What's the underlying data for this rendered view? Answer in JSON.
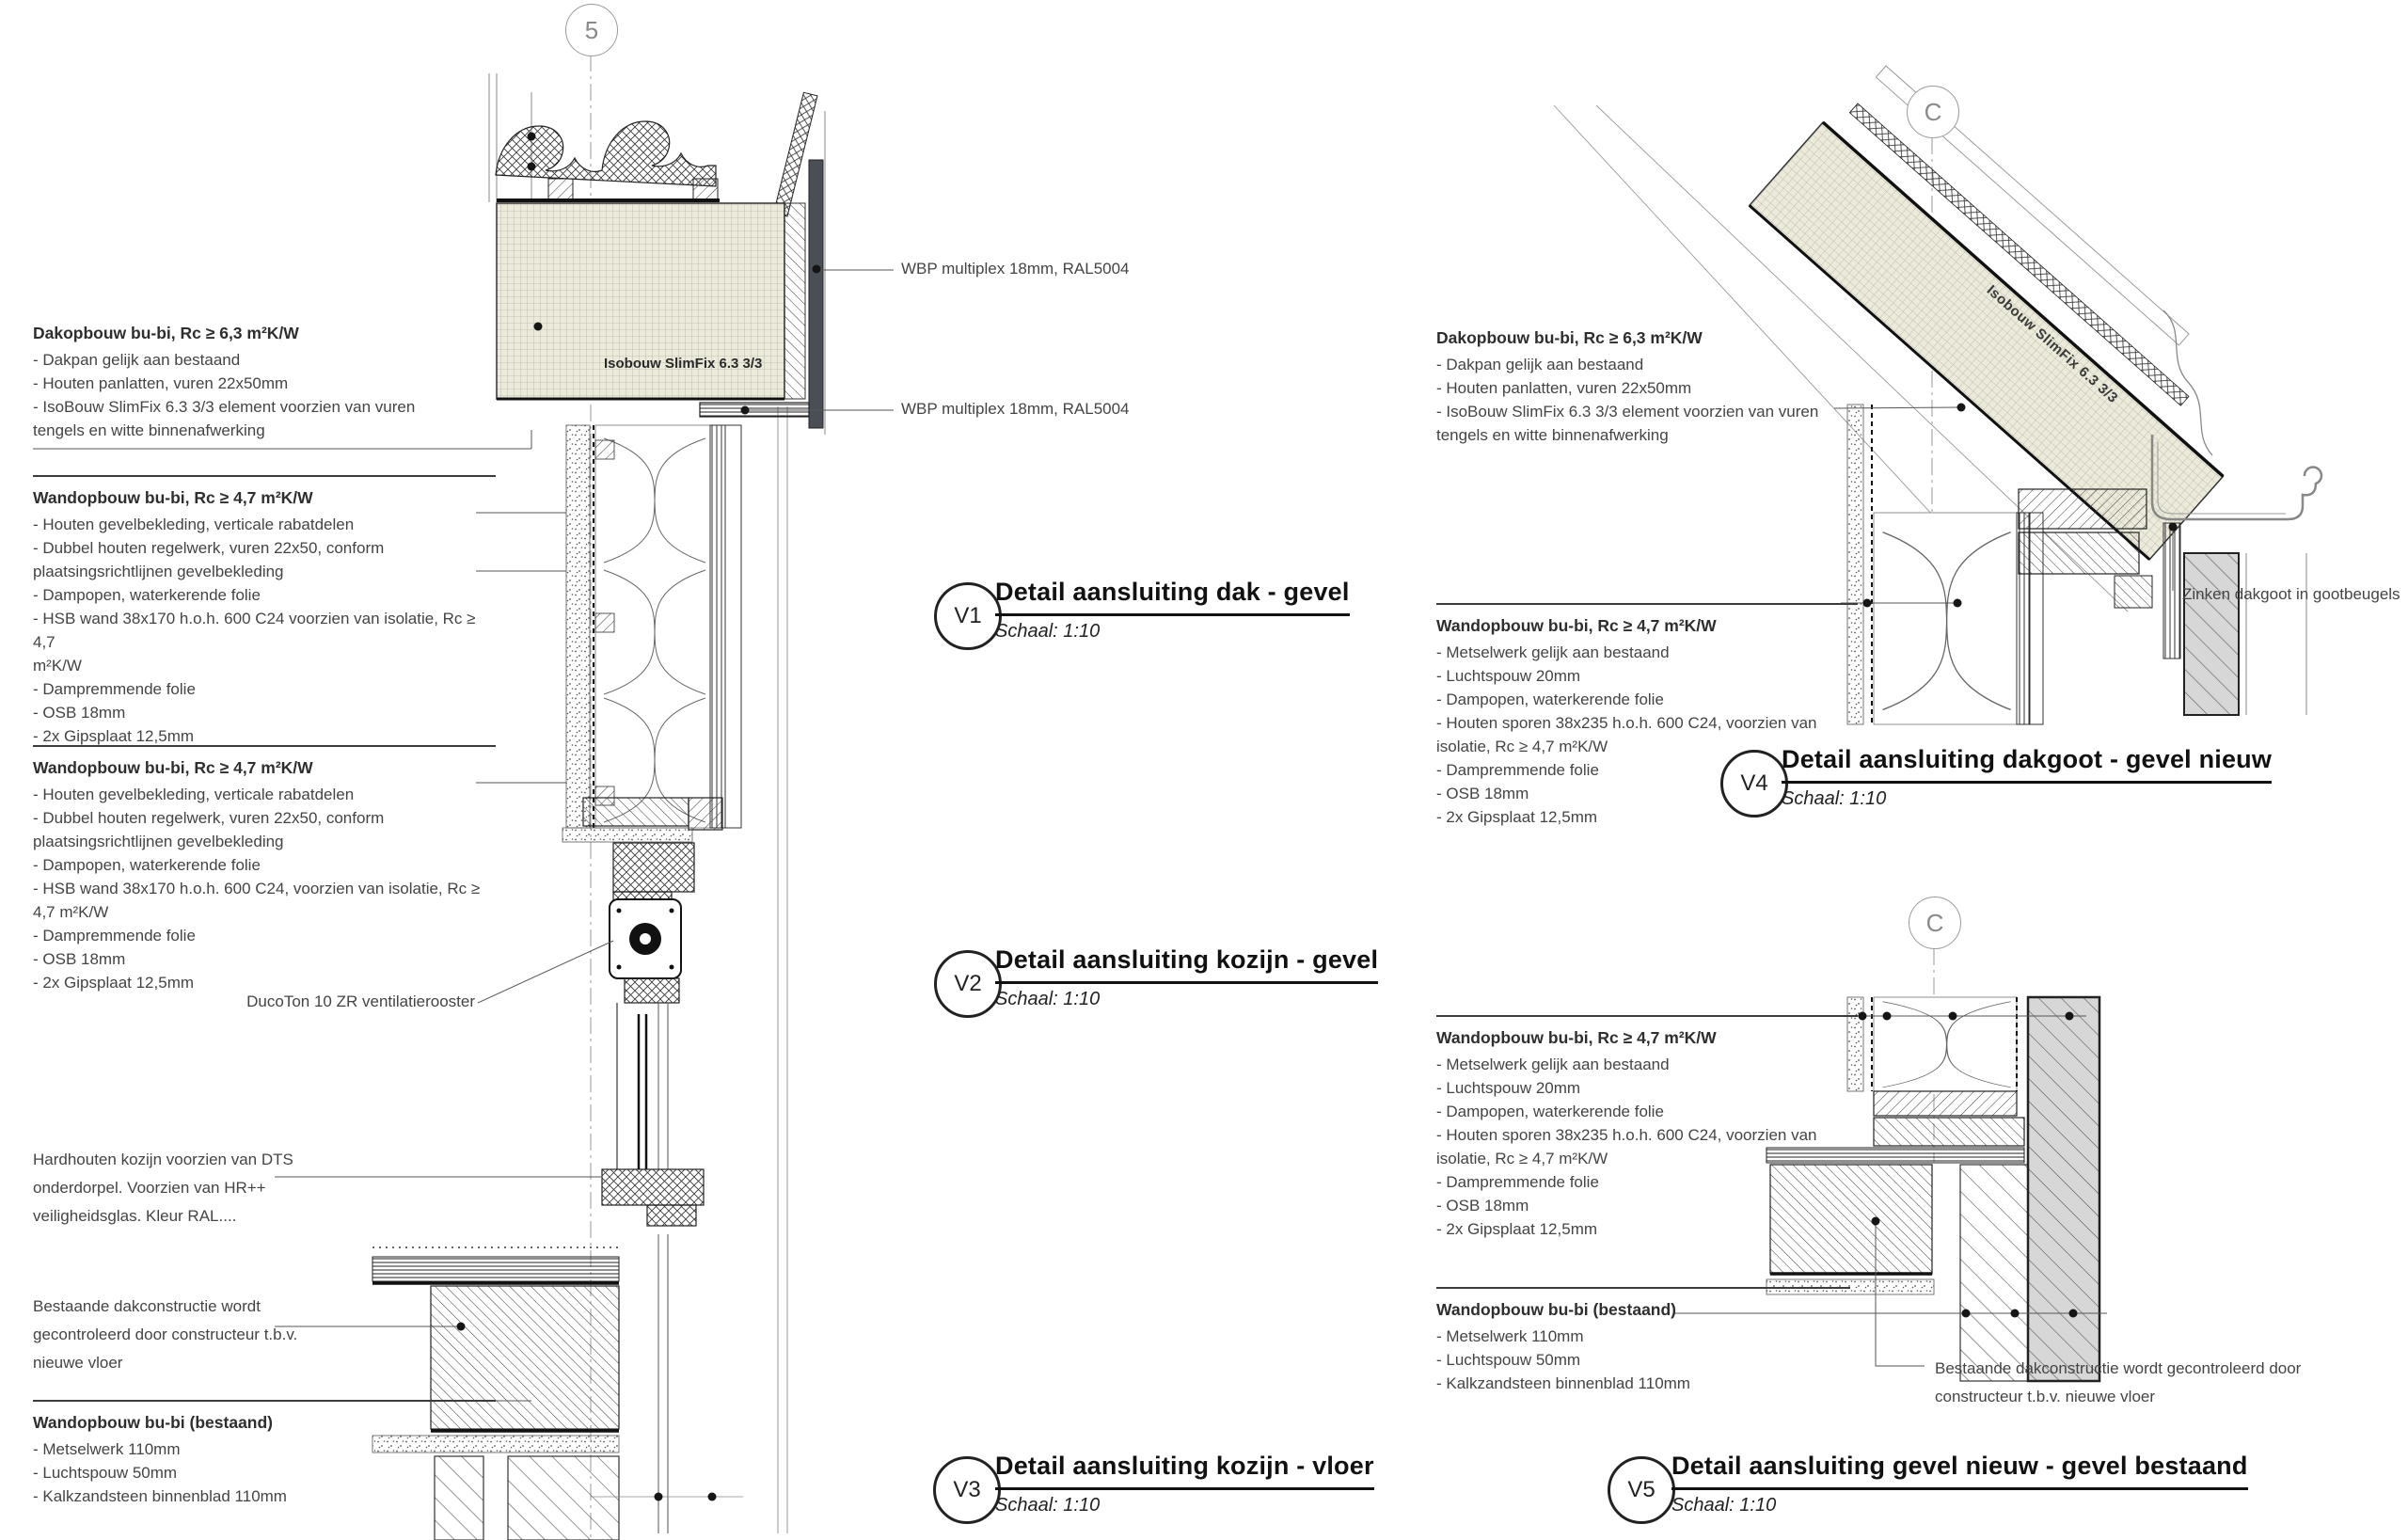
{
  "markers": {
    "left": "5",
    "right_top": "C",
    "right_bottom": "C"
  },
  "details": [
    {
      "id": "V1",
      "title": "Detail aansluiting dak - gevel",
      "scale": "Schaal: 1:10"
    },
    {
      "id": "V2",
      "title": "Detail aansluiting kozijn - gevel",
      "scale": "Schaal: 1:10"
    },
    {
      "id": "V3",
      "title": "Detail aansluiting kozijn - vloer",
      "scale": "Schaal: 1:10"
    },
    {
      "id": "V4",
      "title": "Detail aansluiting dakgoot - gevel nieuw",
      "scale": "Schaal: 1:10"
    },
    {
      "id": "V5",
      "title": "Detail aansluiting gevel nieuw - gevel bestaand",
      "scale": "Schaal: 1:10"
    }
  ],
  "spec_blocks": [
    {
      "title": "Dakopbouw bu-bi, Rc ≥ 6,3 m²K/W",
      "items": [
        "- Dakpan gelijk aan bestaand",
        "- Houten panlatten, vuren 22x50mm",
        "- IsoBouw SlimFix 6.3 3/3 element voorzien van vuren",
        "tengels en witte binnenafwerking"
      ]
    },
    {
      "title": "Wandopbouw bu-bi, Rc ≥ 4,7 m²K/W",
      "items": [
        "- Houten gevelbekleding, verticale rabatdelen",
        "- Dubbel houten regelwerk, vuren 22x50, conform",
        "plaatsingsrichtlijnen gevelbekleding",
        "- Dampopen, waterkerende folie",
        "- HSB wand 38x170 h.o.h. 600 C24 voorzien van isolatie, Rc ≥ 4,7",
        "m²K/W",
        "- Dampremmende folie",
        "- OSB 18mm",
        "- 2x Gipsplaat 12,5mm"
      ]
    },
    {
      "title": "Wandopbouw bu-bi, Rc ≥ 4,7 m²K/W",
      "items": [
        "- Houten gevelbekleding, verticale rabatdelen",
        "- Dubbel houten regelwerk, vuren 22x50, conform",
        "plaatsingsrichtlijnen gevelbekleding",
        "- Dampopen, waterkerende folie",
        "- HSB wand 38x170 h.o.h. 600 C24, voorzien van isolatie, Rc ≥",
        "4,7 m²K/W",
        "- Dampremmende folie",
        "- OSB 18mm",
        "- 2x Gipsplaat 12,5mm"
      ]
    },
    {
      "items": [
        "Hardhouten kozijn voorzien van DTS",
        "onderdorpel. Voorzien van HR++",
        "veiligheidsglas. Kleur RAL...."
      ]
    },
    {
      "items": [
        "Bestaande dakconstructie wordt",
        "gecontroleerd door constructeur t.b.v.",
        "nieuwe vloer"
      ]
    },
    {
      "title": "Wandopbouw bu-bi (bestaand)",
      "items": [
        "- Metselwerk 110mm",
        "- Luchtspouw 50mm",
        "- Kalkzandsteen binnenblad 110mm"
      ]
    },
    {
      "title": "Dakopbouw bu-bi, Rc ≥ 6,3 m²K/W",
      "items": [
        "- Dakpan gelijk aan bestaand",
        "- Houten panlatten, vuren 22x50mm",
        "- IsoBouw SlimFix 6.3 3/3 element voorzien van vuren",
        "tengels en witte binnenafwerking"
      ]
    },
    {
      "title": "Wandopbouw bu-bi, Rc ≥ 4,7 m²K/W",
      "items": [
        "- Metselwerk gelijk aan bestaand",
        "- Luchtspouw 20mm",
        "- Dampopen, waterkerende folie",
        "- Houten sporen 38x235 h.o.h. 600 C24, voorzien van",
        "isolatie, Rc ≥ 4,7 m²K/W",
        "- Dampremmende folie",
        "- OSB 18mm",
        "- 2x Gipsplaat 12,5mm"
      ]
    },
    {
      "title": "Wandopbouw bu-bi, Rc ≥ 4,7 m²K/W",
      "items": [
        "- Metselwerk gelijk aan bestaand",
        "- Luchtspouw 20mm",
        "- Dampopen, waterkerende folie",
        "- Houten sporen 38x235 h.o.h. 600 C24, voorzien van",
        "isolatie, Rc ≥ 4,7 m²K/W",
        "- Dampremmende folie",
        "- OSB 18mm",
        "- 2x Gipsplaat 12,5mm"
      ]
    },
    {
      "title": "Wandopbouw bu-bi (bestaand)",
      "items": [
        "- Metselwerk 110mm",
        "- Luchtspouw 50mm",
        "- Kalkzandsteen binnenblad 110mm"
      ]
    }
  ],
  "callouts": {
    "wbp_top": "WBP multiplex 18mm, RAL5004",
    "wbp_bottom": "WBP multiplex 18mm, RAL5004",
    "ducoton": "DucoTon 10 ZR ventilatierooster",
    "zinken_dakgoot": "Zinken dakgoot in gootbeugels",
    "bestaande_lines": [
      "Bestaande dakconstructie wordt gecontroleerd door",
      "constructeur t.b.v. nieuwe vloer"
    ]
  },
  "panel_labels": {
    "v1": "Isobouw SlimFix 6.3 3/3",
    "v4": "Isobouw SlimFix 6.3 3/3"
  },
  "colors": {
    "ink": "#1a1a1a",
    "panel_fill": "#eceadb",
    "existing_fill": "#d7d7d7",
    "wbp_fill": "#4a4f55"
  }
}
